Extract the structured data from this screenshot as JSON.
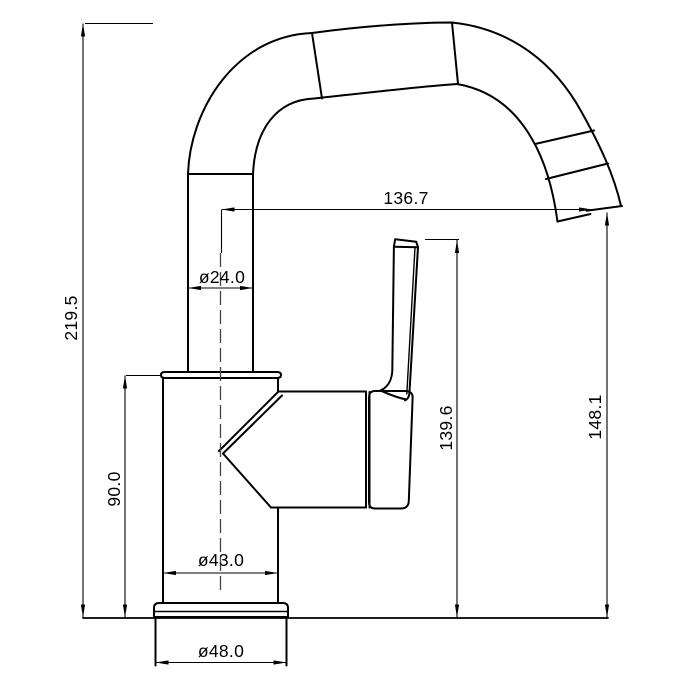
{
  "colors": {
    "background": "#ffffff",
    "line": "#000000",
    "text": "#000000"
  },
  "drawing": {
    "subject": "single-handle-basin-faucet-side-elevation",
    "dimensions": {
      "total_height": "219.5",
      "body_height": "90.0",
      "pipe_diameter": "ø24.0",
      "spout_reach": "136.7",
      "handle_height": "139.6",
      "outlet_height": "148.1",
      "body_diameter": "ø43.0",
      "base_diameter": "ø48.0"
    }
  }
}
